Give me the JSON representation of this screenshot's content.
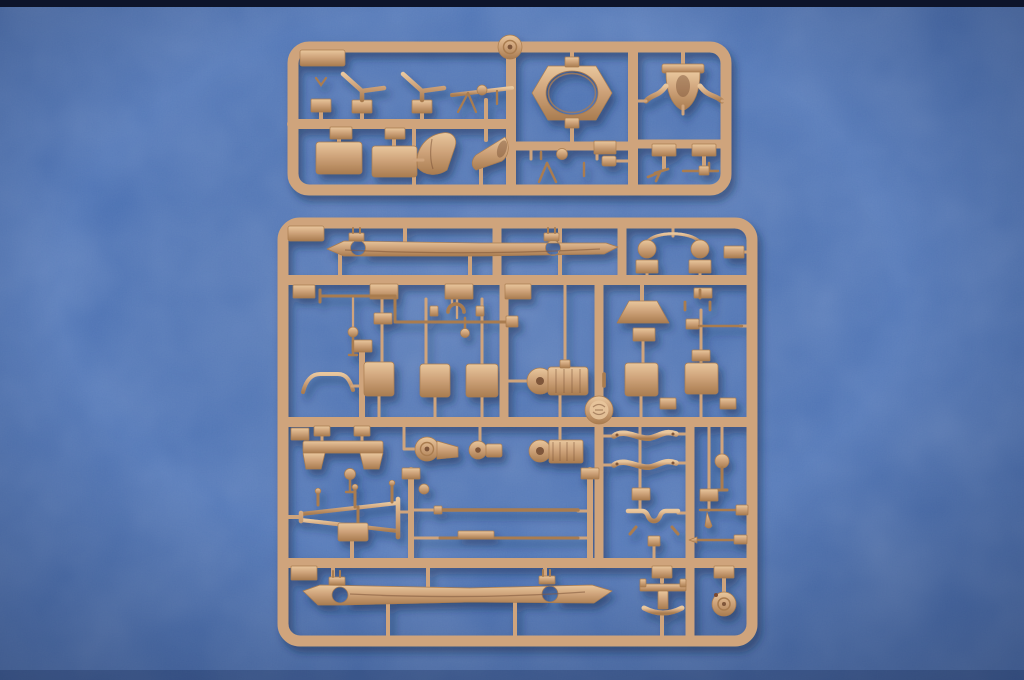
{
  "scene": {
    "description": "Two tan injection-molded plastic model kit sprues photographed on a blue cloth-textured backdrop",
    "subject": "military vehicle model kit part frames",
    "sprue_count": "2"
  },
  "colors": {
    "bg": "#4169ae",
    "bg-light": "#4f7ac4",
    "bg-dark": "#2c4f8e",
    "top-strip": "#0d142a",
    "sprue": "#cfa47b",
    "sprue-light": "#e9c79d",
    "sprue-dark": "#a97c50",
    "sprue-deep": "#7e563a",
    "shadow": "#16254c",
    "rust-dot": "#7a4a33"
  },
  "sprues": {
    "upper": {
      "parts": [
        "corner-gusset",
        "fork-pin",
        "control-lever-1",
        "control-lever-2",
        "machine-gun-small",
        "storage-box-1",
        "storage-box-2",
        "seat-fan",
        "funnel-horn",
        "hub-disc",
        "mg-ring-mount",
        "machine-gun-mg34",
        "ammo-box",
        "gun-shield-cradle",
        "bracket-left",
        "bracket-right",
        "pistol-part",
        "t-rod-part"
      ]
    },
    "lower": {
      "parts": [
        "chassis-rail-right",
        "headlight-pair-brush-guard",
        "frame-edge-block",
        "steering-linkage",
        "clamp-bracket",
        "mushroom-knob-1",
        "panel-1",
        "panel-2",
        "panel-3",
        "panel-right-1",
        "panel-right-2",
        "grab-handle",
        "transfer-case",
        "lampshade-fender",
        "bracket-bar",
        "thin-rod",
        "bench-seat",
        "mushroom-knob-2",
        "axle-differential-large",
        "axle-differential-small",
        "axle-housing",
        "mold-medallion",
        "sway-bar-1",
        "sway-bar-2",
        "ball-lever",
        "tow-a-frame",
        "axle-rod-1",
        "axle-rod-2",
        "hump-bracket",
        "w-bracket",
        "teardrop-rod-1",
        "teardrop-rod-2",
        "chassis-rail-left",
        "i-beam-crossmember",
        "idler-drum"
      ]
    }
  }
}
